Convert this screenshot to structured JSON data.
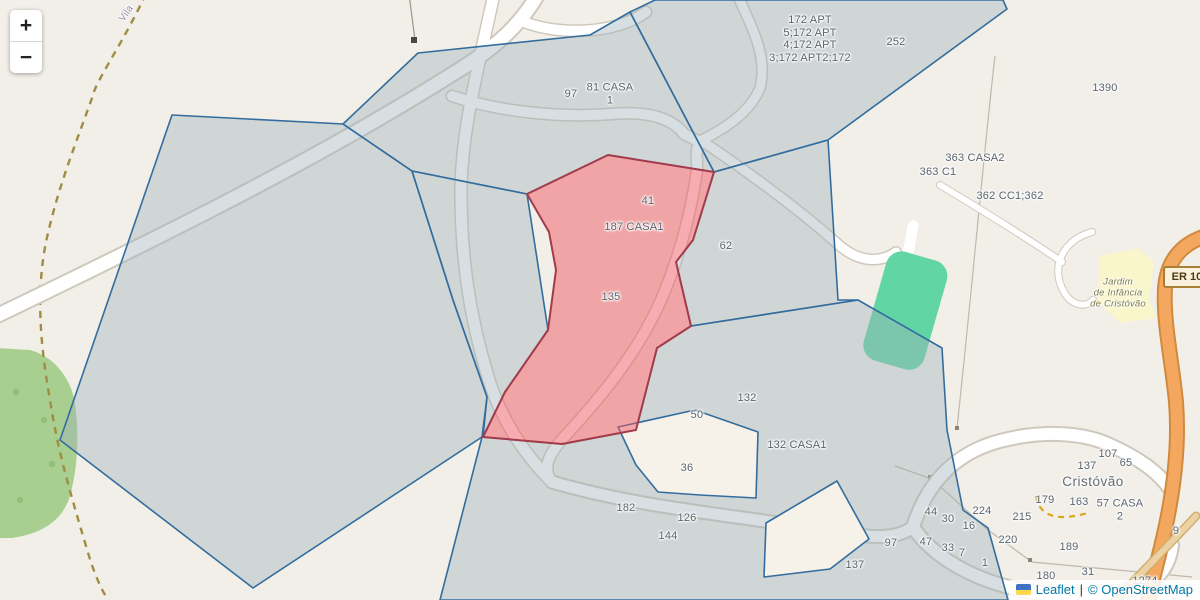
{
  "app": {
    "type": "leaflet-map"
  },
  "colors": {
    "background": "#f2efe9",
    "parcel_fill": "rgba(160,178,186,0.42)",
    "parcel_border": "#336d9e",
    "selected_parcel_fill": "rgba(238,90,100,0.5)",
    "selected_parcel_border": "#a23b4b",
    "pitch_green": "#62d5a4",
    "wood_green": "#a9cf90",
    "school_yellow": "#faf6cb",
    "major_road_orange": "#f3a75f",
    "link_blue": "#0078a8"
  },
  "zoom_control": {
    "zoom_in": "+",
    "zoom_out": "−"
  },
  "road_shield": {
    "text": "ER 108"
  },
  "attribution": {
    "leaflet": "Leaflet",
    "separator": "|",
    "osm": "© OpenStreetMap"
  },
  "labels": [
    {
      "text": "Vila"
    },
    {
      "text": "97"
    },
    {
      "text": "81 CASA\n1"
    },
    {
      "text": "172 APT\n5;172 APT\n4;172 APT\n3;172 APT2;172"
    },
    {
      "text": "252"
    },
    {
      "text": "1390"
    },
    {
      "text": "363 CASA2"
    },
    {
      "text": "363 C1"
    },
    {
      "text": "362 CC1;362"
    },
    {
      "text": "41"
    },
    {
      "text": "187 CASA1"
    },
    {
      "text": "62"
    },
    {
      "text": "135"
    },
    {
      "text": "Jardim\nde Infância\nde Cristóvão"
    },
    {
      "text": "132"
    },
    {
      "text": "50"
    },
    {
      "text": "132 CASA1"
    },
    {
      "text": "36"
    },
    {
      "text": "182"
    },
    {
      "text": "126"
    },
    {
      "text": "144"
    },
    {
      "text": "107"
    },
    {
      "text": "65"
    },
    {
      "text": "137"
    },
    {
      "text": "Cristóvão"
    },
    {
      "text": "179"
    },
    {
      "text": "163"
    },
    {
      "text": "57 CASA\n2"
    },
    {
      "text": "224"
    },
    {
      "text": "215"
    },
    {
      "text": "44"
    },
    {
      "text": "30"
    },
    {
      "text": "16"
    },
    {
      "text": "9"
    },
    {
      "text": "220"
    },
    {
      "text": "189"
    },
    {
      "text": "97"
    },
    {
      "text": "47"
    },
    {
      "text": "33"
    },
    {
      "text": "7"
    },
    {
      "text": "1"
    },
    {
      "text": "137"
    },
    {
      "text": "180"
    },
    {
      "text": "31"
    },
    {
      "text": "1274"
    }
  ]
}
